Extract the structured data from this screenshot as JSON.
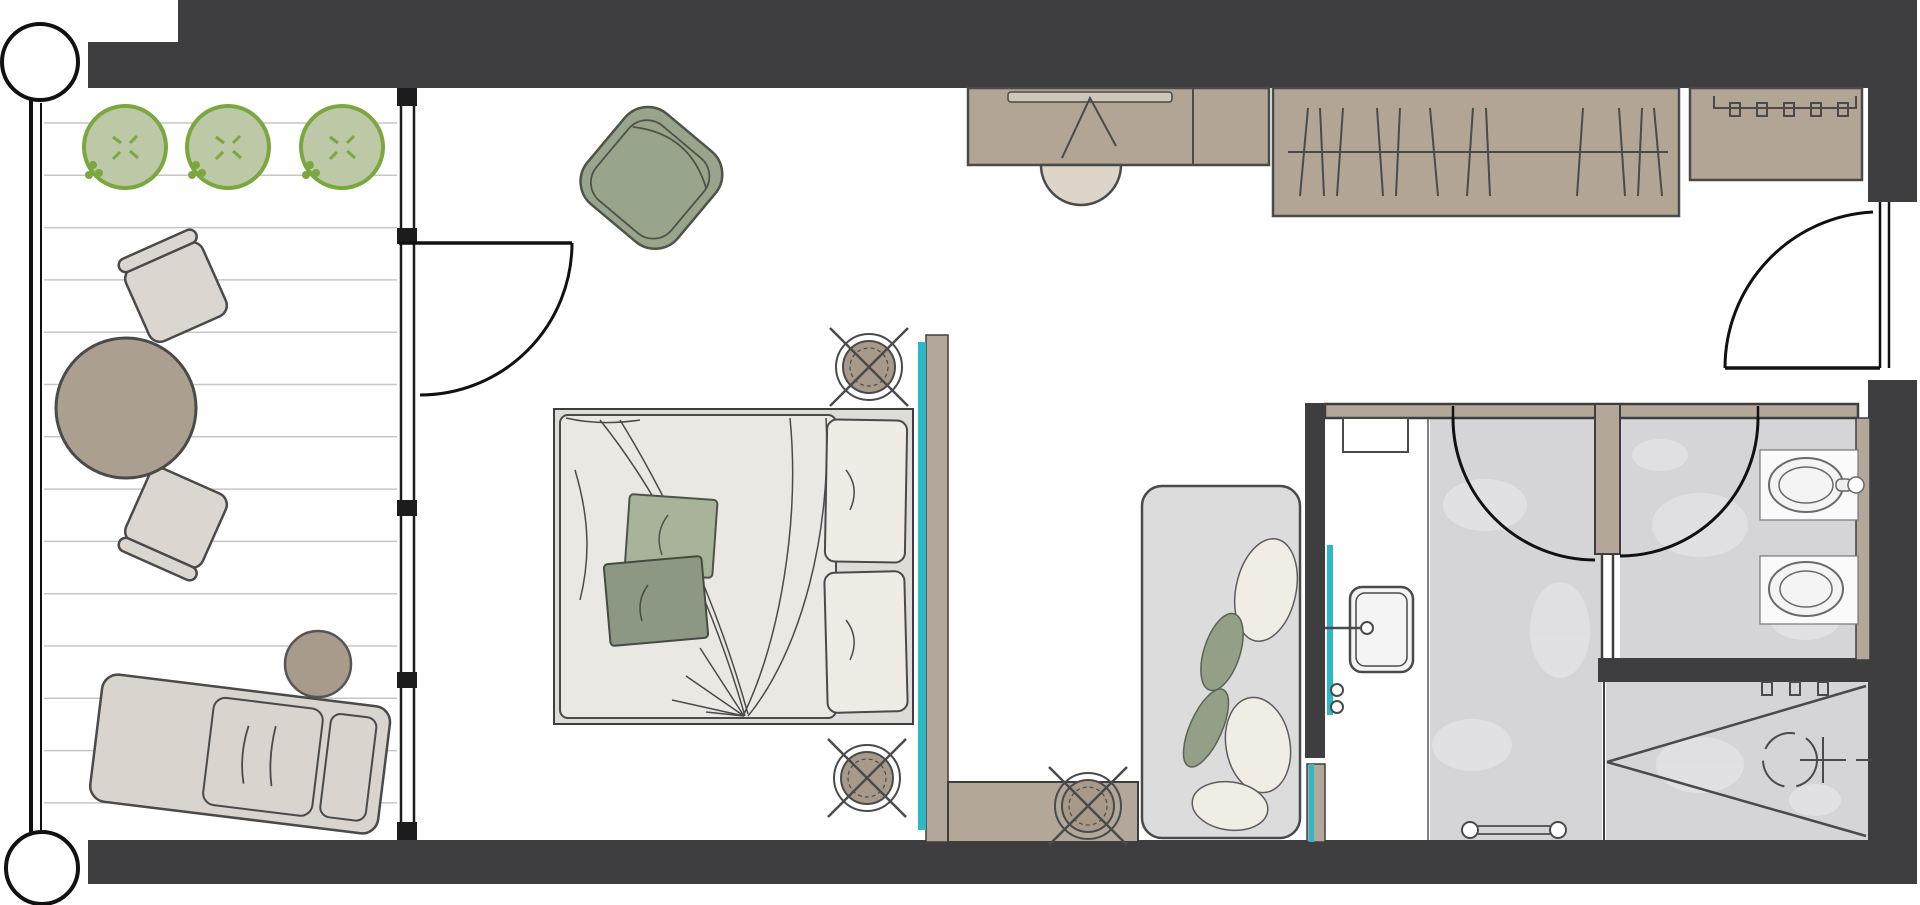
{
  "plan": {
    "kind": "architectural-floor-plan",
    "rooms": [
      "balcony",
      "bedroom",
      "dressing-area",
      "bathroom-vanity",
      "shower-room",
      "wc",
      "walk-in-shower"
    ],
    "furniture": [
      "outdoor-lounger",
      "outdoor-side-table",
      "outdoor-round-table",
      "outdoor-chair",
      "outdoor-chair",
      "planter-tree",
      "planter-tree",
      "planter-tree",
      "armchair",
      "double-bed",
      "desk",
      "desk-stool",
      "wardrobe",
      "luggage-console",
      "bench-daybed",
      "washbasin",
      "bidet",
      "toilet",
      "shower-head",
      "towel-rail"
    ]
  },
  "colors": {
    "wall": "#3e3e40",
    "wall_tan": "#b3a79a",
    "furniture_tan": "#b2a595",
    "teal": "#2ab9c5",
    "deck_line": "#c6c6c6",
    "tree_fill": "#bcc8a6",
    "tree_stroke": "#7aa83e",
    "sage_chair": "#99a48d",
    "bed_duvet": "#eae8e2",
    "bed_frame": "#dedcd6",
    "pillow": "#efece6",
    "cushion_light": "#a8b39a",
    "cushion_dark": "#8c9883",
    "balcony_furniture": "#dbd7d0",
    "table_round": "#ab9f90",
    "side_table": "#a89b8c",
    "marble": "#d5d5d7",
    "marble_patch": "#e3e3e5",
    "bench": "#dcdcdd",
    "lamp": "#a89a8b",
    "fixture": "#f4f4f4",
    "outline": "#4a4a4a"
  },
  "balcony": {
    "deck": {
      "x1": 44,
      "x2": 397,
      "y_start": 123,
      "step": 52.3,
      "count": 14
    },
    "trees": {
      "radius": 41,
      "items": [
        {
          "cx": 125,
          "cy": 147
        },
        {
          "cx": 228,
          "cy": 147
        },
        {
          "cx": 342,
          "cy": 147
        }
      ]
    }
  },
  "wardrobe": {
    "rail": {
      "x1": 1288,
      "x2": 1668,
      "y": 152
    },
    "hangers": [
      [
        1304,
        4
      ],
      [
        1322,
        -2
      ],
      [
        1340,
        3
      ],
      [
        1380,
        -3
      ],
      [
        1398,
        2
      ],
      [
        1434,
        -4
      ],
      [
        1470,
        3
      ],
      [
        1488,
        -2
      ],
      [
        1580,
        3
      ],
      [
        1622,
        -3
      ],
      [
        1640,
        2
      ],
      [
        1658,
        -4
      ]
    ]
  },
  "hooks": {
    "console": {
      "xs": [
        1735,
        1762,
        1789,
        1816,
        1843
      ],
      "y": 103
    },
    "shower": {
      "xs": [
        1767,
        1795,
        1823
      ],
      "y": 682
    }
  },
  "lamps": {
    "radius": 33,
    "items": [
      {
        "x": 869,
        "y": 367
      },
      {
        "x": 867,
        "y": 778
      },
      {
        "x": 1088,
        "y": 806
      }
    ]
  },
  "marble_patches": [
    [
      1485,
      505,
      42,
      26
    ],
    [
      1560,
      630,
      30,
      48
    ],
    [
      1472,
      745,
      40,
      26
    ],
    [
      1700,
      525,
      48,
      32
    ],
    [
      1805,
      618,
      36,
      22
    ],
    [
      1660,
      455,
      28,
      16
    ],
    [
      1700,
      765,
      44,
      28
    ],
    [
      1815,
      800,
      26,
      16
    ]
  ]
}
